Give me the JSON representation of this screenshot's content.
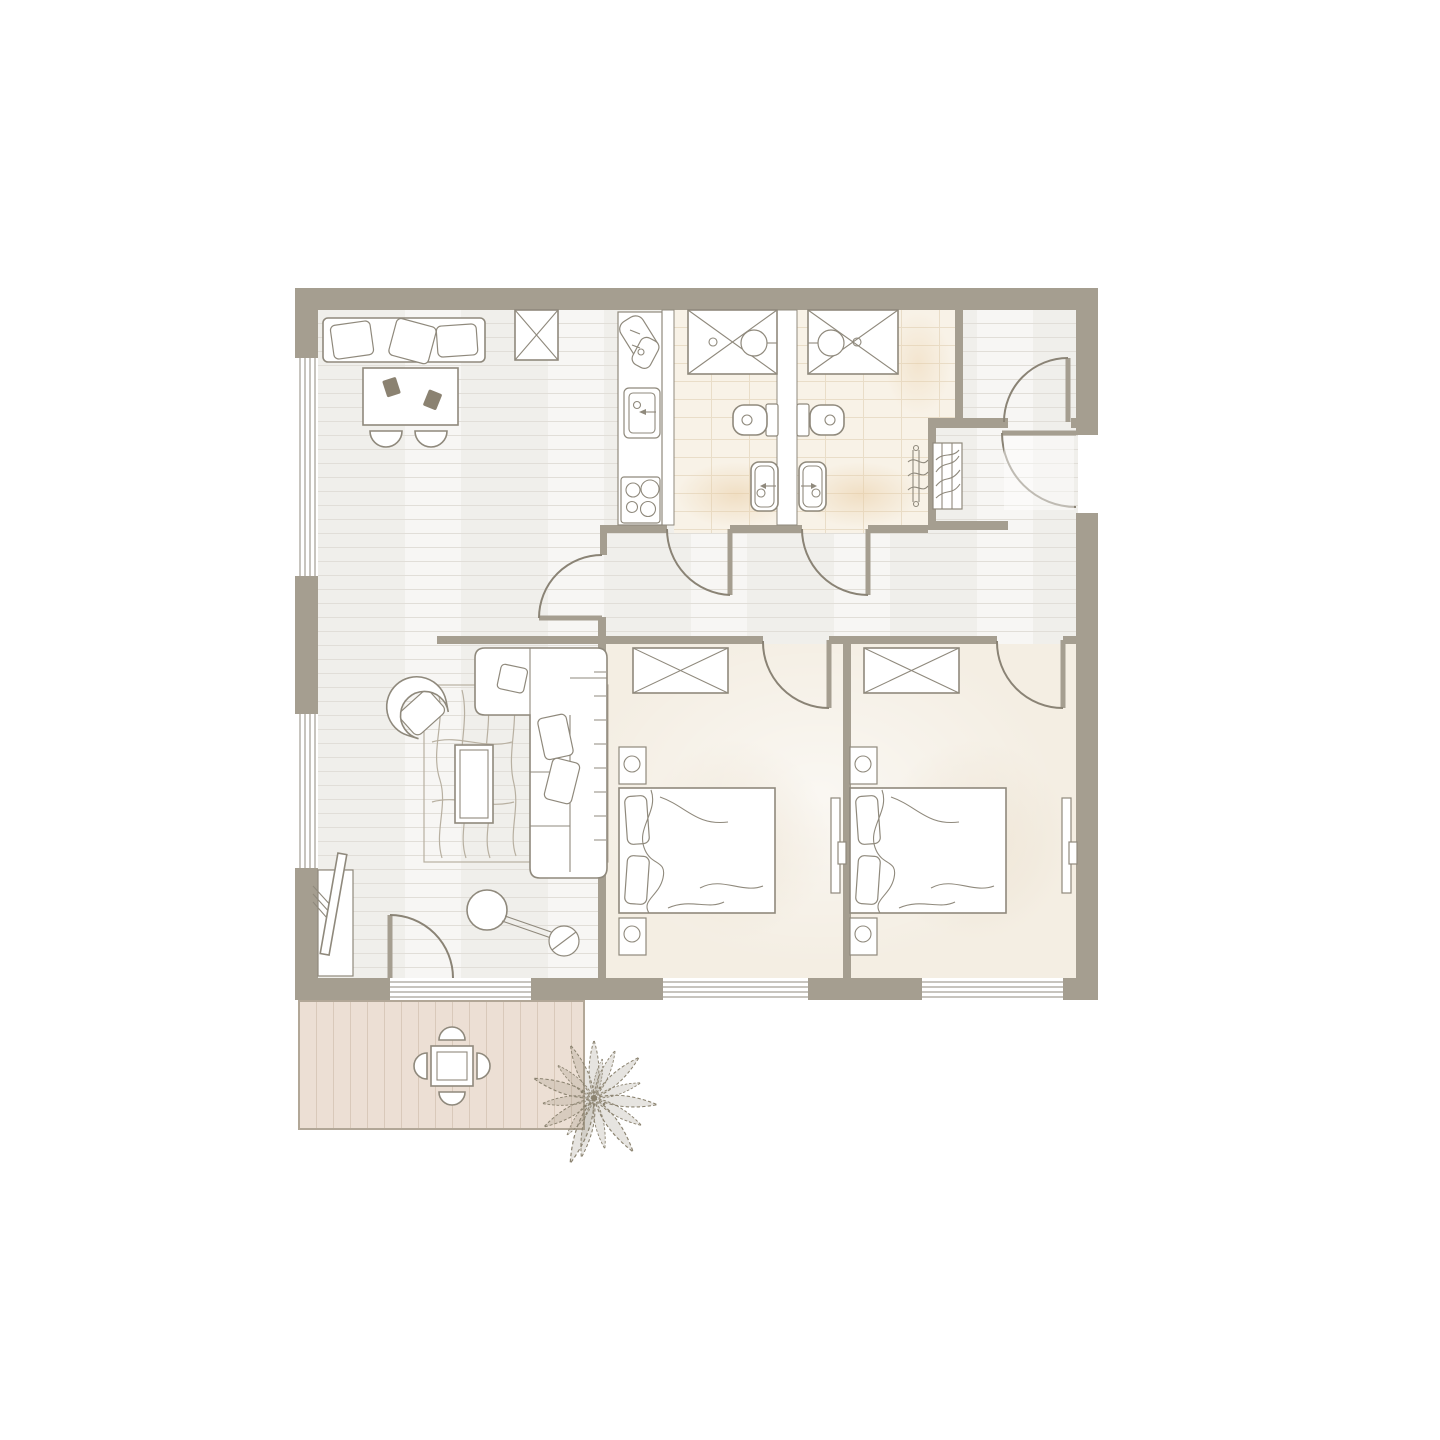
{
  "colors": {
    "wall": "#a59e90",
    "wall_dark": "#8a8375",
    "line": "#8f897c",
    "line_soft": "#b8b0a1",
    "wood": "#f0efeb",
    "wood_line": "#e1ded8",
    "tile": "#f8f2e7",
    "tile_line": "#e9ddc8",
    "carpet": "#f4eee3",
    "deck": "#ecdfd4",
    "deck_line": "#d9c9ba",
    "plant": "#8b8370",
    "accent_dark": "#8b8271"
  },
  "plan": {
    "type": "apartment-floor-plan",
    "rooms": [
      {
        "name": "living-dining-kitchen",
        "floor": "wood",
        "furniture": [
          "dining-bench-with-pillows",
          "dining-table",
          "dining-chair-x2",
          "place-setting-x2",
          "tall-cabinet",
          "kitchen-counter",
          "cutting-board",
          "kitchen-sink",
          "cooktop-4-burner",
          "corner-sofa",
          "sofa-pillow-x3",
          "armchair",
          "rug",
          "coffee-table",
          "floor-lamp",
          "tv-sideboard",
          "tv"
        ]
      },
      {
        "name": "bathroom-1",
        "floor": "tile",
        "furniture": [
          "shower",
          "toilet",
          "washbasin"
        ]
      },
      {
        "name": "bathroom-2",
        "floor": "tile",
        "furniture": [
          "shower",
          "toilet",
          "washbasin",
          "towel-radiator"
        ]
      },
      {
        "name": "entry-hall",
        "floor": "wood",
        "furniture": [
          "towel-closet",
          "door-mat"
        ]
      },
      {
        "name": "storage-room",
        "floor": "wood",
        "furniture": []
      },
      {
        "name": "corridor",
        "floor": "wood",
        "furniture": []
      },
      {
        "name": "bedroom-1",
        "floor": "carpet",
        "furniture": [
          "wardrobe",
          "double-bed",
          "pillow-x2",
          "blanket",
          "nightstand-with-lamp-x2",
          "wall-shelf-desk"
        ]
      },
      {
        "name": "bedroom-2",
        "floor": "carpet",
        "furniture": [
          "wardrobe",
          "double-bed",
          "pillow-x2",
          "blanket",
          "nightstand-with-lamp-x2",
          "wall-shelf-desk"
        ]
      },
      {
        "name": "terrace",
        "floor": "deck",
        "furniture": [
          "outdoor-table",
          "outdoor-chair-x4",
          "plant"
        ]
      }
    ],
    "doors": [
      "entry-door",
      "living-corridor-door",
      "bathroom-1-door",
      "bathroom-2-door",
      "bedroom-1-door",
      "bedroom-2-door",
      "storage-room-door",
      "terrace-door"
    ],
    "windows": [
      "left-window-1",
      "left-window-2",
      "terrace-glass-door",
      "bottom-window-bedroom-1",
      "bottom-window-bedroom-2"
    ]
  }
}
